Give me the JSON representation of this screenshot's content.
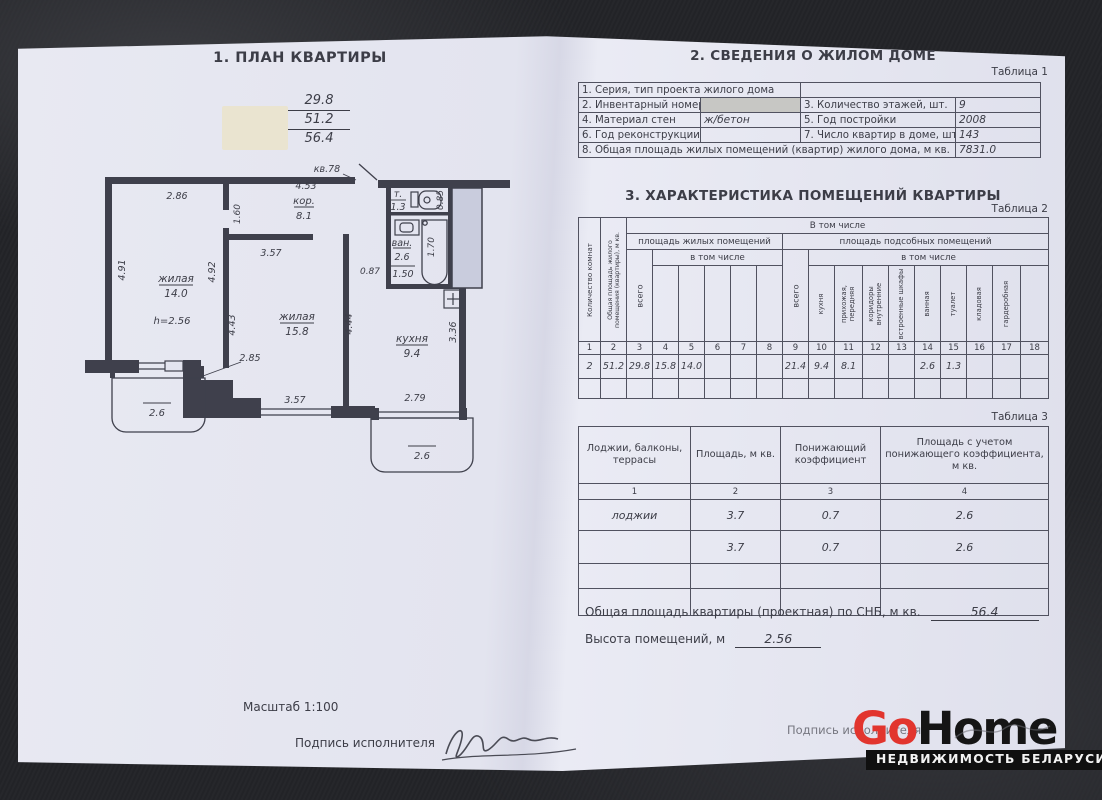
{
  "plan": {
    "title": "1. ПЛАН КВАРТИРЫ",
    "apartment_label": "кв.78",
    "areas": {
      "living": "29.8",
      "total_living": "51.2",
      "overall": "56.4"
    },
    "rooms": {
      "living1_name": "жилая",
      "living1_area": "14.0",
      "living1_height": "h=2.56",
      "living2_name": "жилая",
      "living2_area": "15.8",
      "kitchen_name": "кухня",
      "kitchen_area": "9.4",
      "corridor_name": "кор.",
      "corridor_area": "8.1",
      "bath_name": "ван.",
      "bath_area": "2.6",
      "bath_width": "1.50",
      "wc_name": "т.",
      "wc_area": "1.3",
      "loggia_left_area": "2.6",
      "loggia_right_area": "2.6"
    },
    "dims": {
      "d286": "2.86",
      "d453": "4.53",
      "d160": "1.60",
      "d491": "4.91",
      "d492": "4.92",
      "d357a": "3.57",
      "d443": "4.43",
      "d444": "4.44",
      "d336": "3.36",
      "d087": "0.87",
      "d170": "1.70",
      "d085": "0.85",
      "d285": "2.85",
      "d357b": "3.57",
      "d279": "2.79"
    },
    "scale_label": "Масштаб 1:100",
    "signature_label": "Подпись исполнителя"
  },
  "section2": {
    "title": "2. СВЕДЕНИЯ О ЖИЛОМ ДОМЕ",
    "table_label": "Таблица 1",
    "rows": {
      "r1_label": "1. Серия, тип проекта жилого дома",
      "r1_value": "",
      "r2_label": "2. Инвентарный номер",
      "r2_value": "",
      "r2b_label": "3. Количество этажей, шт.",
      "r2b_value": "9",
      "r3_label": "4. Материал стен",
      "r3_value": "ж/бетон",
      "r3b_label": "5. Год постройки",
      "r3b_value": "2008",
      "r4_label": "6. Год реконструкции",
      "r4_value": "",
      "r4b_label": "7. Число квартир в доме, шт.",
      "r4b_value": "143",
      "r5_label": "8. Общая площадь жилых помещений (квартир) жилого дома, м кв.",
      "r5_value": "7831.0"
    }
  },
  "section3": {
    "title": "3. ХАРАКТЕРИСТИКА ПОМЕЩЕНИЙ КВАРТИРЫ",
    "table_label": "Таблица 2",
    "header": {
      "col1": "Количество комнат",
      "col2": "Общая площадь жилого помещения (квартиры), м кв.",
      "group_top": "В том числе",
      "group_living": "площадь жилых помещений",
      "group_aux": "площадь подсобных помещений",
      "subgroup": "в том числе",
      "total": "всего",
      "col10": "кухня",
      "col11": "прихожая, передняя",
      "col12": "коридоры внутренние",
      "col13": "встроенные шкафы",
      "col14": "ванная",
      "col15": "туалет",
      "col16": "кладовая",
      "col17": "гардеробная"
    },
    "col_numbers": [
      "1",
      "2",
      "3",
      "4",
      "5",
      "6",
      "7",
      "8",
      "9",
      "10",
      "11",
      "12",
      "13",
      "14",
      "15",
      "16",
      "17",
      "18"
    ],
    "values": [
      "2",
      "51.2",
      "29.8",
      "15.8",
      "14.0",
      "",
      "",
      "",
      "21.4",
      "9.4",
      "8.1",
      "",
      "",
      "2.6",
      "1.3",
      "",
      "",
      ""
    ],
    "empty_row": [
      "",
      "",
      "",
      "",
      "",
      "",
      "",
      "",
      "",
      "",
      "",
      "",
      "",
      "",
      "",
      "",
      "",
      ""
    ]
  },
  "table3": {
    "label": "Таблица 3",
    "headers": [
      "Лоджии, балконы, террасы",
      "Площадь, м кв.",
      "Понижающий коэффициент",
      "Площадь с учетом понижающего коэффициента, м кв."
    ],
    "col_numbers": [
      "1",
      "2",
      "3",
      "4"
    ],
    "rows": [
      [
        "лоджии",
        "3.7",
        "0.7",
        "2.6"
      ],
      [
        "",
        "3.7",
        "0.7",
        "2.6"
      ],
      [
        "",
        "",
        "",
        ""
      ],
      [
        "",
        "",
        "",
        ""
      ]
    ]
  },
  "footer": {
    "total_label": "Общая площадь квартиры (проектная) по СНБ, м кв.",
    "total_value": "56.4",
    "height_label": "Высота помещений, м",
    "height_value": "2.56",
    "signature_label": "Подпись исполнителя"
  },
  "logo": {
    "go": "Go",
    "home": "Home",
    "tagline": "НЕДВИЖИМОСТЬ БЕЛАРУСИ",
    "accent_color": "#e2352e",
    "dark_color": "#151515"
  },
  "colors": {
    "paper": "#e3e4ef",
    "ink": "#3c3d47",
    "table_line": "#515260",
    "background": "#232428",
    "shaft_fill": "#c9ccdd",
    "redact_gray": "#c7c7c4",
    "redact_beige": "#eae4d0"
  }
}
